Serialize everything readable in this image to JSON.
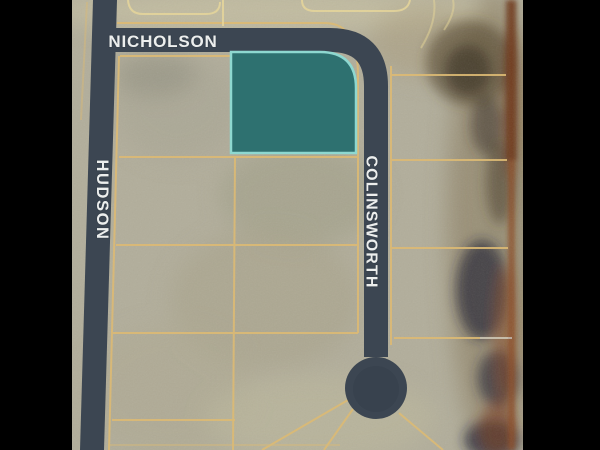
{
  "map": {
    "street_labels": [
      {
        "name": "NICHOLSON",
        "orientation": "horizontal"
      },
      {
        "name": "HUDSON",
        "orientation": "vertical"
      },
      {
        "name": "COLINSWORTH",
        "orientation": "vertical"
      }
    ],
    "highlighted_parcel": {
      "fill": "#2e7170",
      "border": "#8ed8d0"
    },
    "colors": {
      "street": "#3c4652",
      "street_label_text": "#eceeed",
      "parcel_line": "#dcba74",
      "parcel_line_light": "#e8d79a",
      "land_base": "#b2ae9b",
      "terrain_dark_brown": "#54452f",
      "terrain_rust": "#8a4724",
      "letterbox": "#000000"
    }
  }
}
